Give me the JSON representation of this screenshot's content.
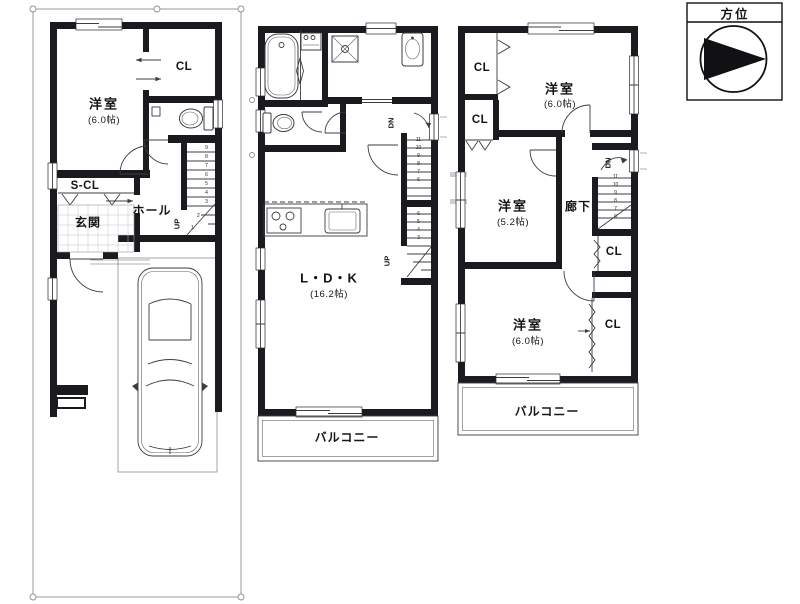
{
  "compass": {
    "title": "方位"
  },
  "colors": {
    "wall": "#1a1a1f",
    "thin_line": "#3c3c42",
    "site_boundary": "#9a9aa0",
    "background": "#ffffff",
    "text": "#151518"
  },
  "floor1": {
    "room_name": "洋室",
    "room_area": "(6.0帖)",
    "closet": "CL",
    "shoe_closet": "S-CL",
    "entrance": "玄関",
    "hall": "ホール",
    "stair_up": "UP",
    "stair_numbers": "9\n8\n7\n6\n5\n4\n3",
    "stair_num_2": "2",
    "stair_num_1": "1"
  },
  "floor2": {
    "ldk_name": "L・D・K",
    "ldk_area": "(16.2帖)",
    "balcony": "バルコニー",
    "stair_down": "DN",
    "stair_up": "UP",
    "stair_numbers_down": "11\n10\n9\n8\n7\n6",
    "stair_numbers_up": "6\n5\n4\n3"
  },
  "floor3": {
    "room_top_name": "洋室",
    "room_top_area": "(6.0帖)",
    "room_mid_name": "洋室",
    "room_mid_area": "(5.2帖)",
    "room_bottom_name": "洋室",
    "room_bottom_area": "(6.0帖)",
    "corridor": "廊下",
    "closet1": "CL",
    "closet2": "CL",
    "closet3": "CL",
    "closet4": "CL",
    "stair_down": "DN",
    "stair_numbers": "11\n10\n9\n8\n7\n6",
    "balcony": "バルコニー"
  }
}
